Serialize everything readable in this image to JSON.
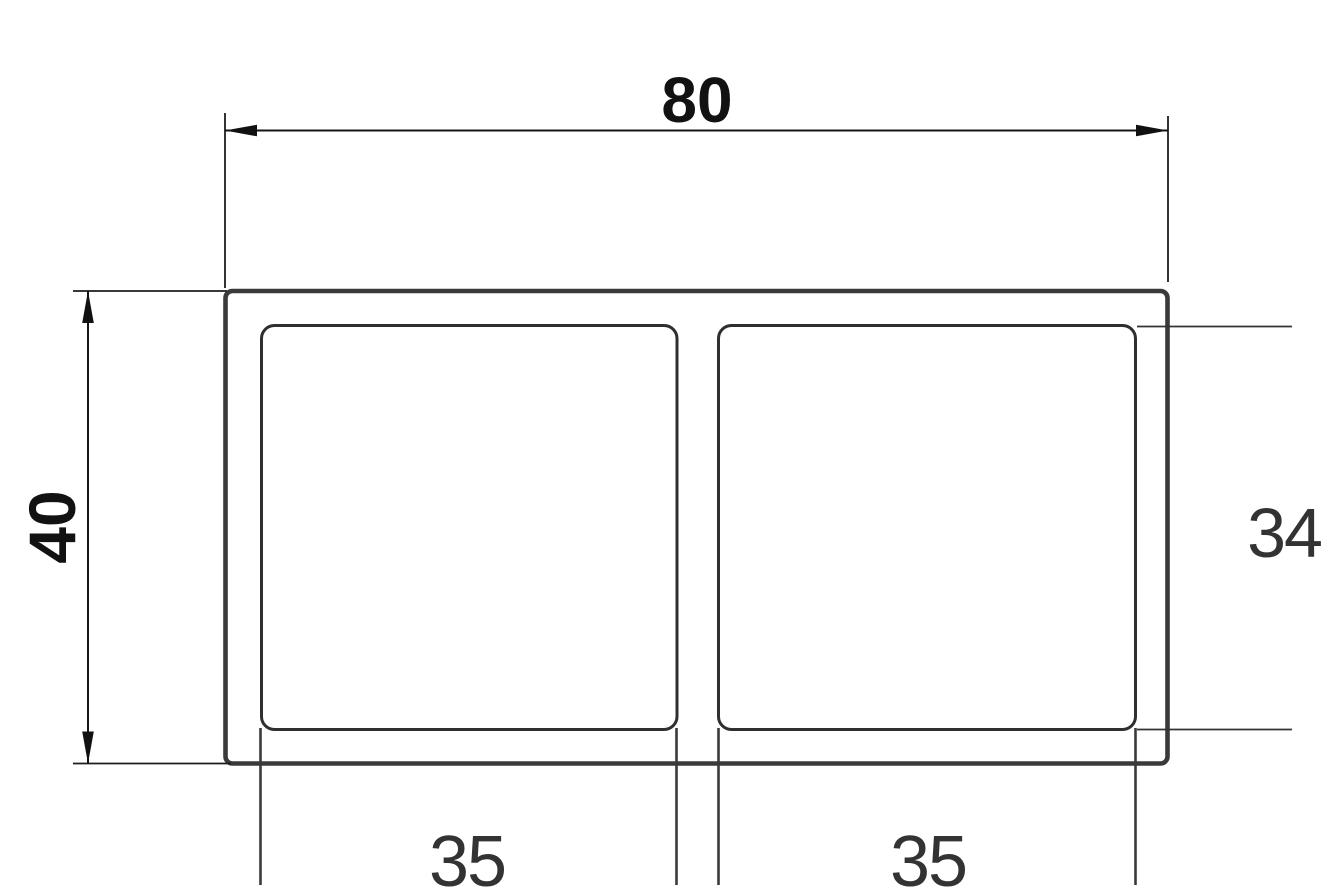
{
  "drawing": {
    "type": "technical-dimension-drawing",
    "subject": "rectangular-tube-profile-cross-section",
    "dimensions": {
      "outer_width": {
        "value": "80"
      },
      "outer_height": {
        "value": "40"
      },
      "cavity_height": {
        "value": "34"
      },
      "left_cavity_width": {
        "value": "35"
      },
      "right_cavity_width": {
        "value": "35"
      }
    },
    "colors": {
      "background": "#ffffff",
      "profile_outline": "#3a3a3a",
      "cavity_outline": "#2f2f2f",
      "dimension_line": "#161616",
      "extension_line_dark": "#1d1d1d",
      "extension_line_gray": "#3a3a3a",
      "extension_line_34": "#333333",
      "arrow": "#111111",
      "primary_label": "#121212",
      "secondary_label": "#333333"
    }
  }
}
